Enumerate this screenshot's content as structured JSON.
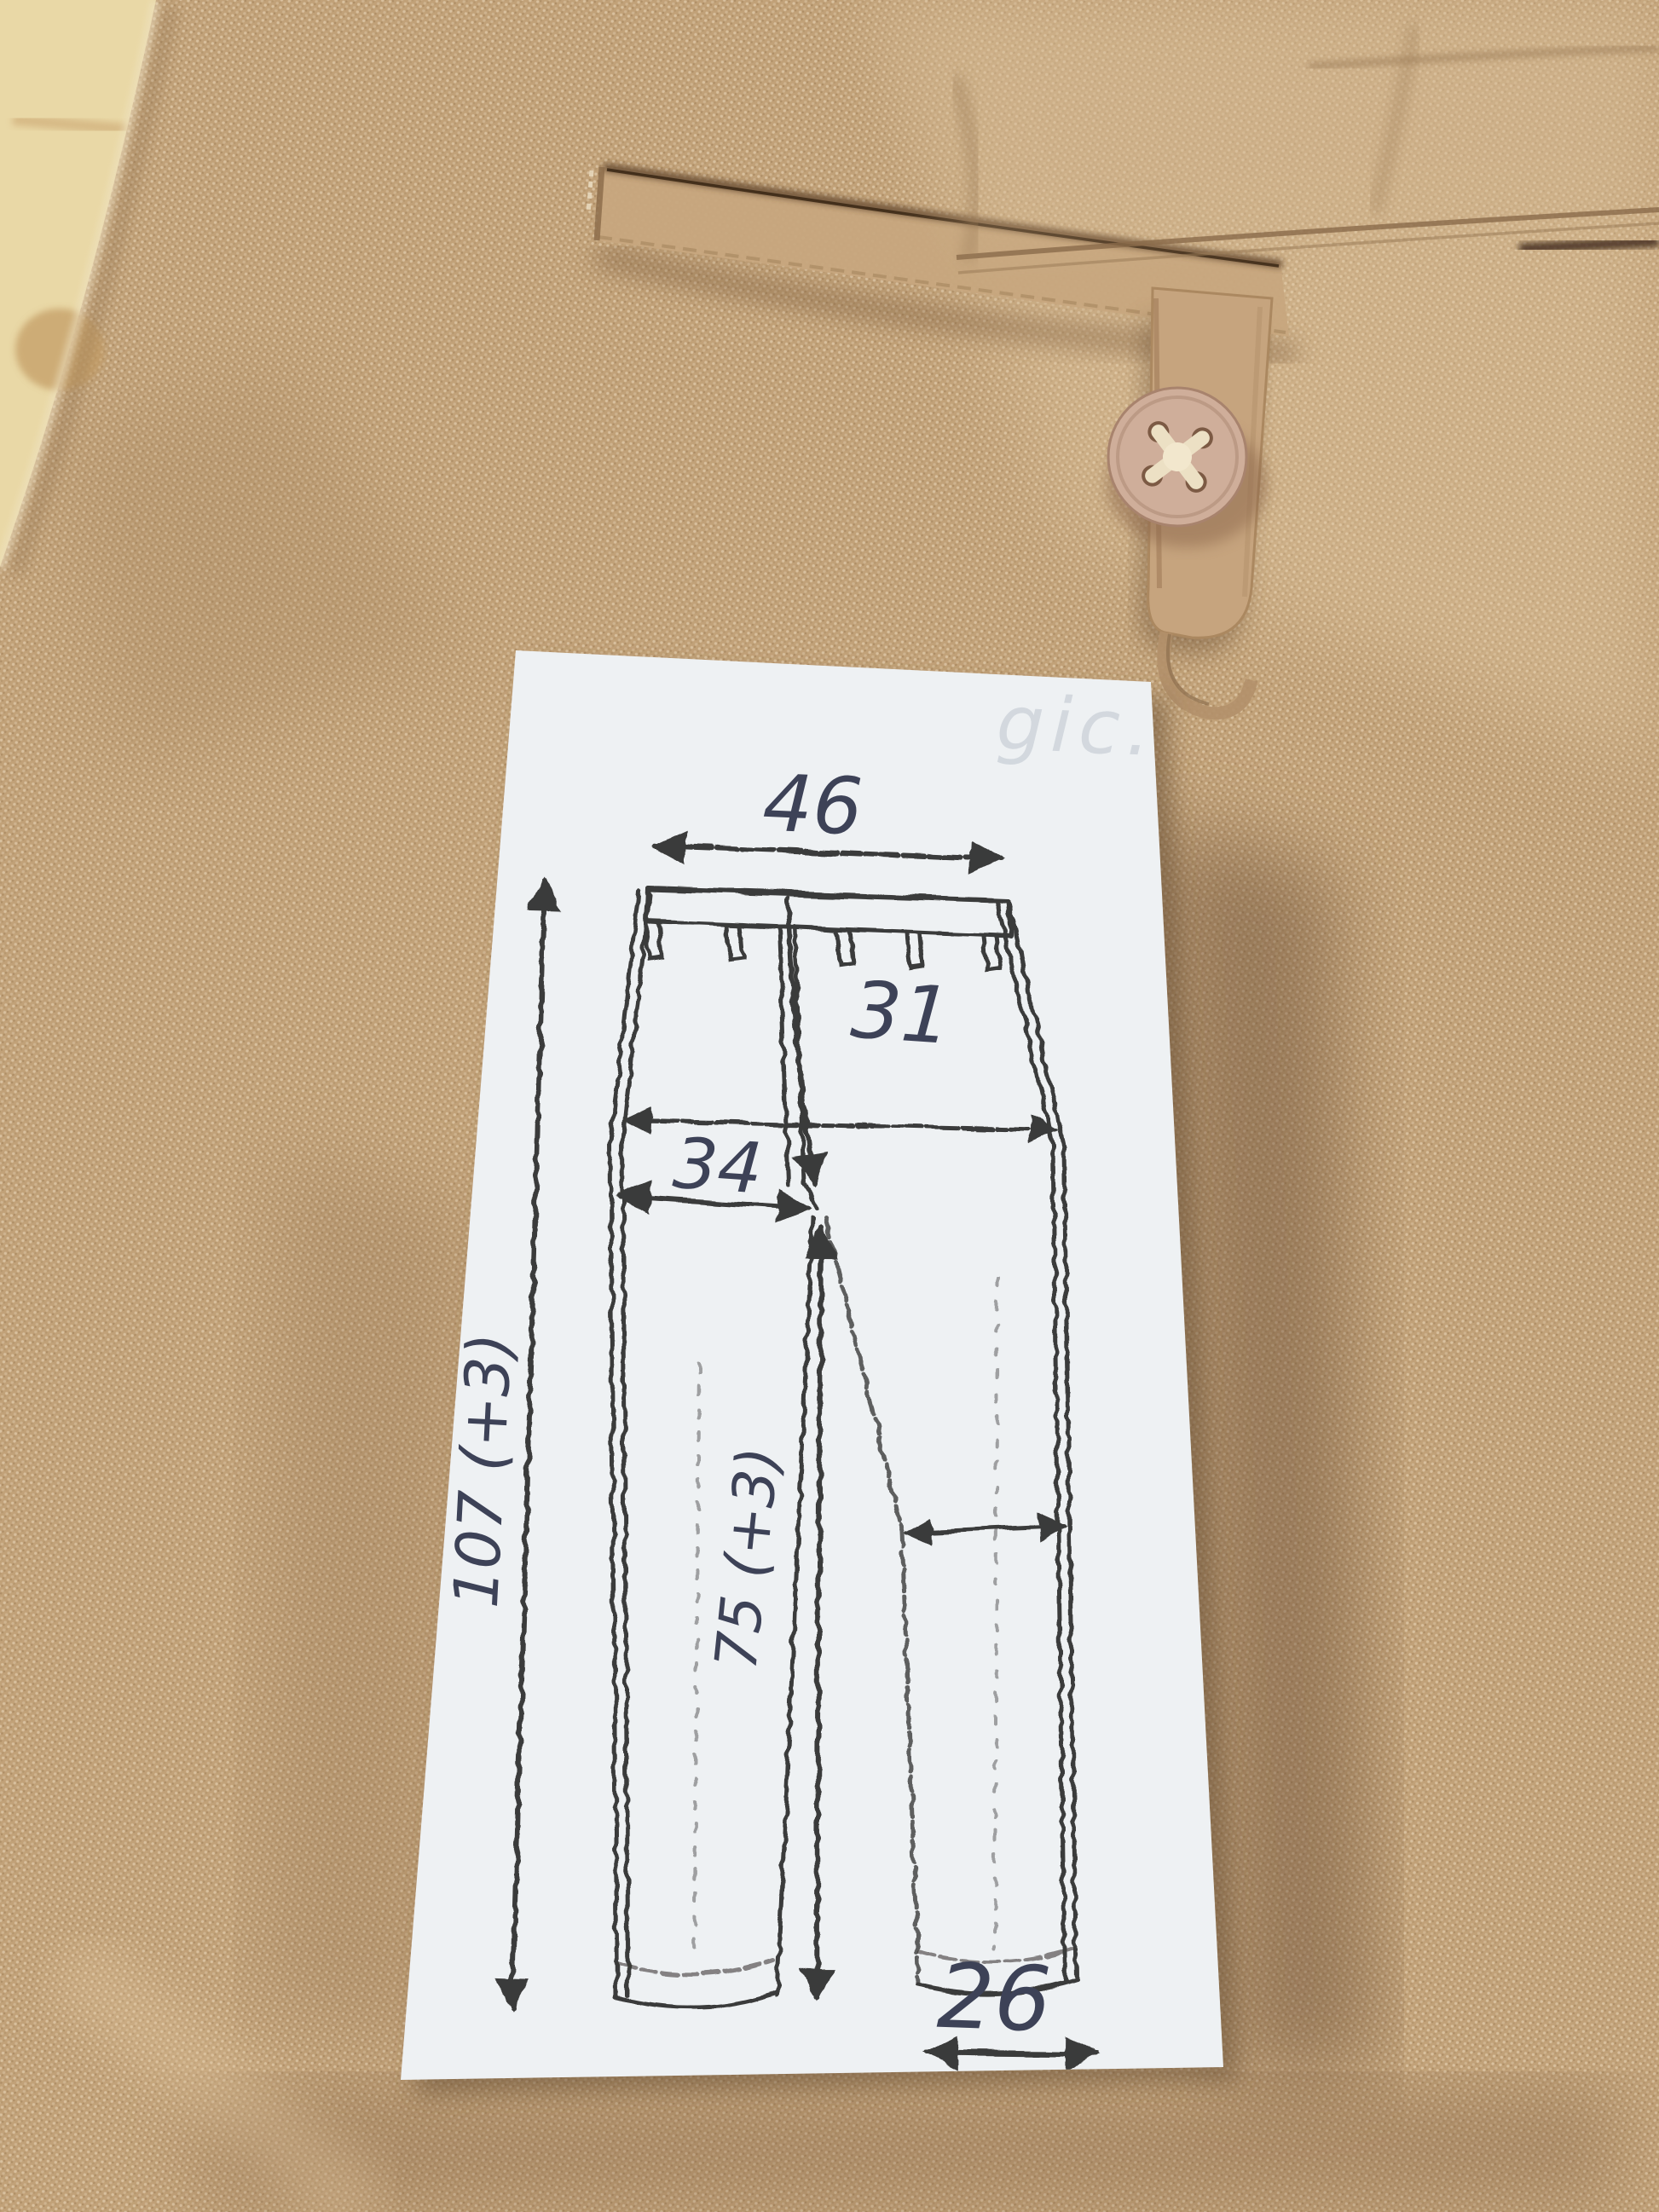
{
  "note": {
    "watermark": "gic.",
    "sketch_icon": "trousers-front-outline-sketch"
  },
  "measurements": {
    "waist": "46",
    "rise": "31",
    "hip_half": "34",
    "outseam": "107 (+3)",
    "inseam": "75 (+3)",
    "hem": "26"
  },
  "colors": {
    "fabric": "#c2a47c",
    "fabric_shadow": "#6a4e34",
    "wood": "#e9d8a6",
    "paper": "#eef1f3",
    "sketch": "#232220",
    "ink": "#3d4257",
    "watermark": "#b8c0ca",
    "button": "#cfae9a"
  }
}
